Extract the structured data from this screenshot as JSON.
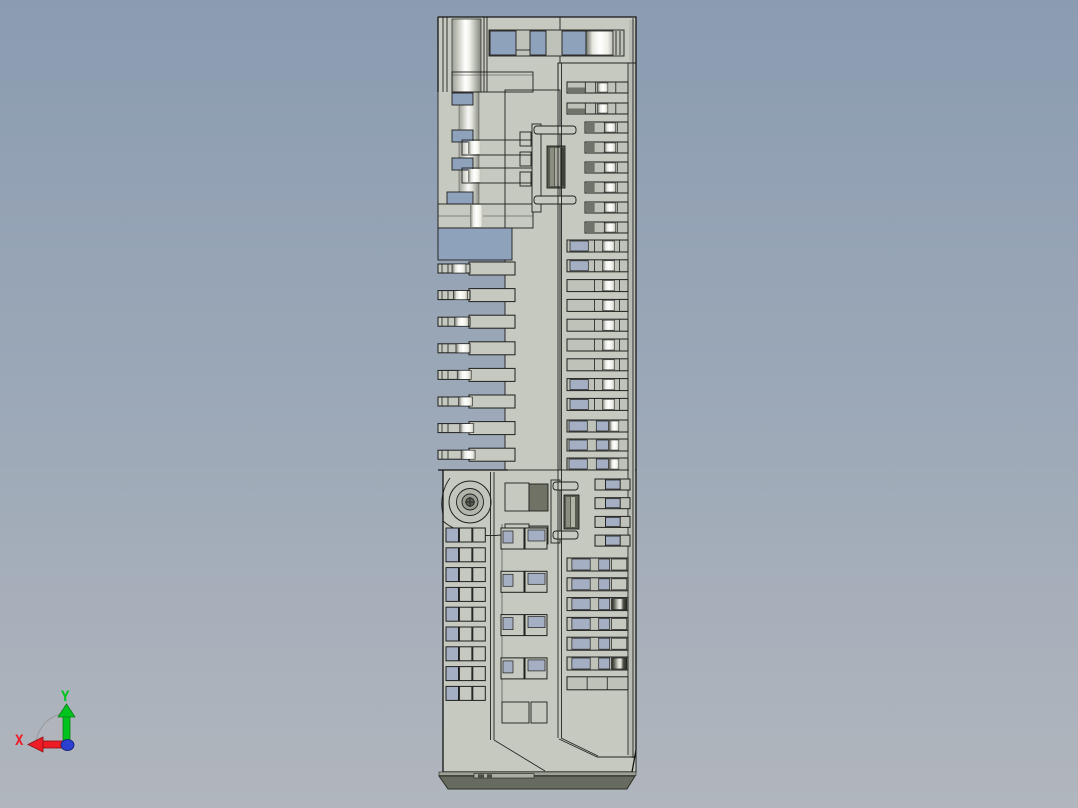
{
  "viewport": {
    "background_gradient": {
      "top": "#8b9cb1",
      "middle": "#9aa7b7",
      "bottom": "#b1b6bd"
    }
  },
  "orientation_triad": {
    "x_label": "X",
    "y_label": "Y",
    "x_axis_color": "#ee1c25",
    "y_axis_color": "#00c41e",
    "origin_color": "#2b3fd0",
    "pie_color": "#b2b5ba"
  },
  "model": {
    "name": "connector-housing-side-view",
    "colors": {
      "body": "#c6c9bf",
      "body_dark": "#bfc2b8",
      "edge": "#1e1e1e",
      "hole_blue": "#8fa2bc",
      "hole_blue_light": "#a4afc3",
      "dark_slot": "#585b50",
      "dark_segment": "#70736a",
      "base_dark": "#676a5e"
    },
    "right_slot_groups": [
      {
        "x": 567,
        "y": 82,
        "w": 61,
        "h": 11,
        "count": 2,
        "pitch": 21,
        "style": "grayDark"
      },
      {
        "x": 585,
        "y": 122,
        "w": 43,
        "h": 11,
        "count": 6,
        "pitch": 20,
        "style": "grayHi"
      },
      {
        "x": 567,
        "y": 240,
        "w": 61,
        "h": 12,
        "count": 9,
        "pitch": 19.8,
        "style": "mixBlue",
        "blue_rows": [
          0,
          1,
          7,
          8
        ]
      },
      {
        "x": 567,
        "y": 420,
        "w": 61,
        "h": 12,
        "count": 3,
        "pitch": 19,
        "style": "blue"
      },
      {
        "x": 595,
        "y": 479,
        "w": 35,
        "h": 11,
        "count": 4,
        "pitch": 18.7,
        "style": "smallMix"
      },
      {
        "x": 567,
        "y": 558,
        "w": 61,
        "h": 13,
        "count": 7,
        "pitch": 19.8,
        "style": "lowMetal",
        "metal_rows": [
          2,
          5
        ],
        "plain_rows": [
          6
        ]
      }
    ],
    "comb_teeth": {
      "x": 438,
      "tip_w": 32,
      "body_x": 469,
      "body_w": 46,
      "y": 262,
      "count": 8,
      "pitch": 26.6,
      "h": 13
    },
    "left_grid": {
      "x": 446,
      "y": 528,
      "rows": 9,
      "cols": 3,
      "cw": 12.5,
      "ch": 14,
      "px": 13.4,
      "py": 19.8
    },
    "mid_pairs": {
      "x": 501,
      "y": 528,
      "count": 4,
      "pitch": 43.3
    }
  }
}
